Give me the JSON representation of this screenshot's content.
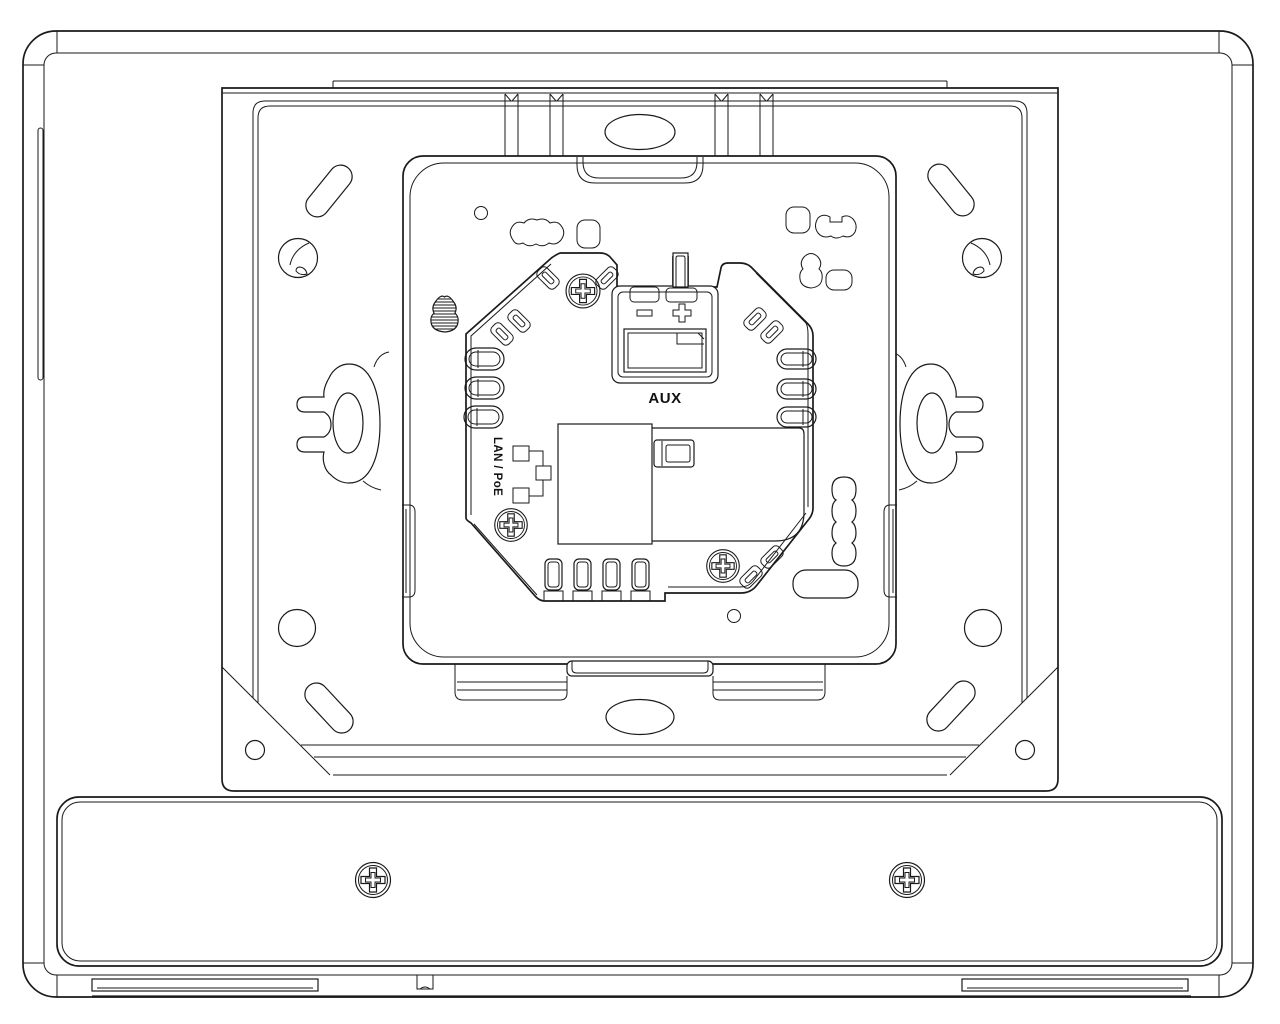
{
  "drawing": {
    "labels": {
      "aux": "AUX",
      "lan_poe": "LAN / PoE",
      "minus": "−",
      "plus": "+"
    },
    "colors": {
      "line": "#1a1a1a",
      "background": "#ffffff"
    }
  }
}
